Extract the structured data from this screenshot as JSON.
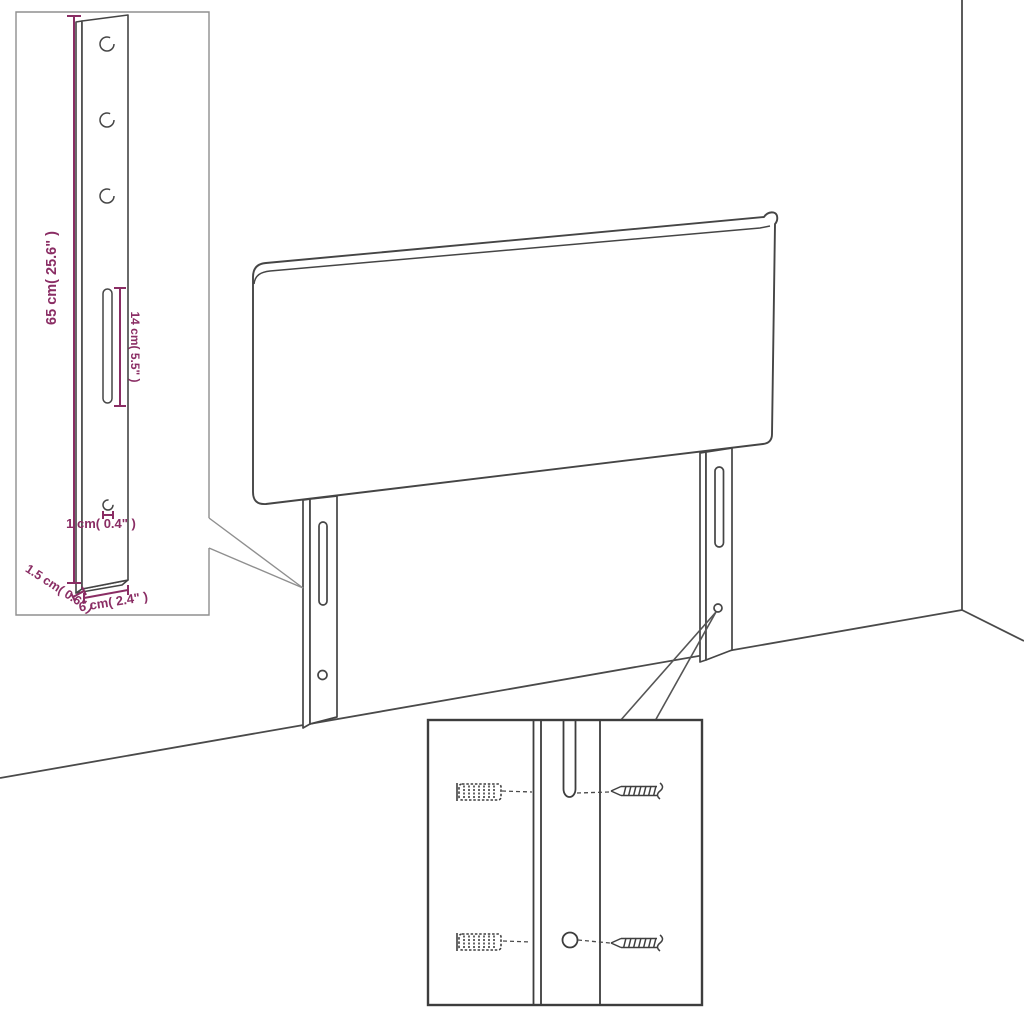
{
  "diagram": {
    "background": "#ffffff",
    "colors": {
      "outline": "#454545",
      "dimension": "#8A2D64",
      "detail_box_border": "#8f8f8f",
      "hardware_box_border": "#3d3d3d"
    },
    "labels": {
      "leg_height": "65 cm( 25.6\" )",
      "slot_length": "14 cm( 5.5\" )",
      "hole_diameter": "1 cm( 0.4\" )",
      "leg_thickness": "1.5 cm( 0.6\" )",
      "leg_width": "6 cm( 2.4\" )"
    },
    "counts": {
      "legs": 2,
      "leg_detail_holes": 3,
      "wall_plugs": 2,
      "screws": 2
    }
  }
}
